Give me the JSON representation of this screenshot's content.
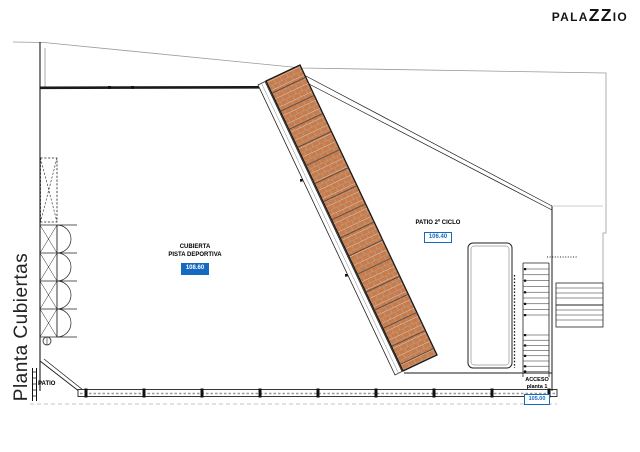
{
  "logo": {
    "part1": "PALA",
    "part2": "ZZ",
    "part3": "IO"
  },
  "title": {
    "text": "Planta Cubiertas"
  },
  "plan": {
    "cubierta_label": {
      "line1": "CUBIERTA",
      "line2": "PISTA DEPORTIVA",
      "level": "108.60"
    },
    "patio2_label": {
      "text": "PATIO 2º CICLO",
      "level": "106.40"
    },
    "acceso_label": {
      "line1": "ACCESO",
      "line2": "planta 1",
      "level": "105.00"
    },
    "patio_label": {
      "text": "PATIO"
    },
    "colors": {
      "roof_tile": "#c87c4c",
      "level_blue": "#1669c0",
      "boundary_gray": "#999999"
    }
  }
}
